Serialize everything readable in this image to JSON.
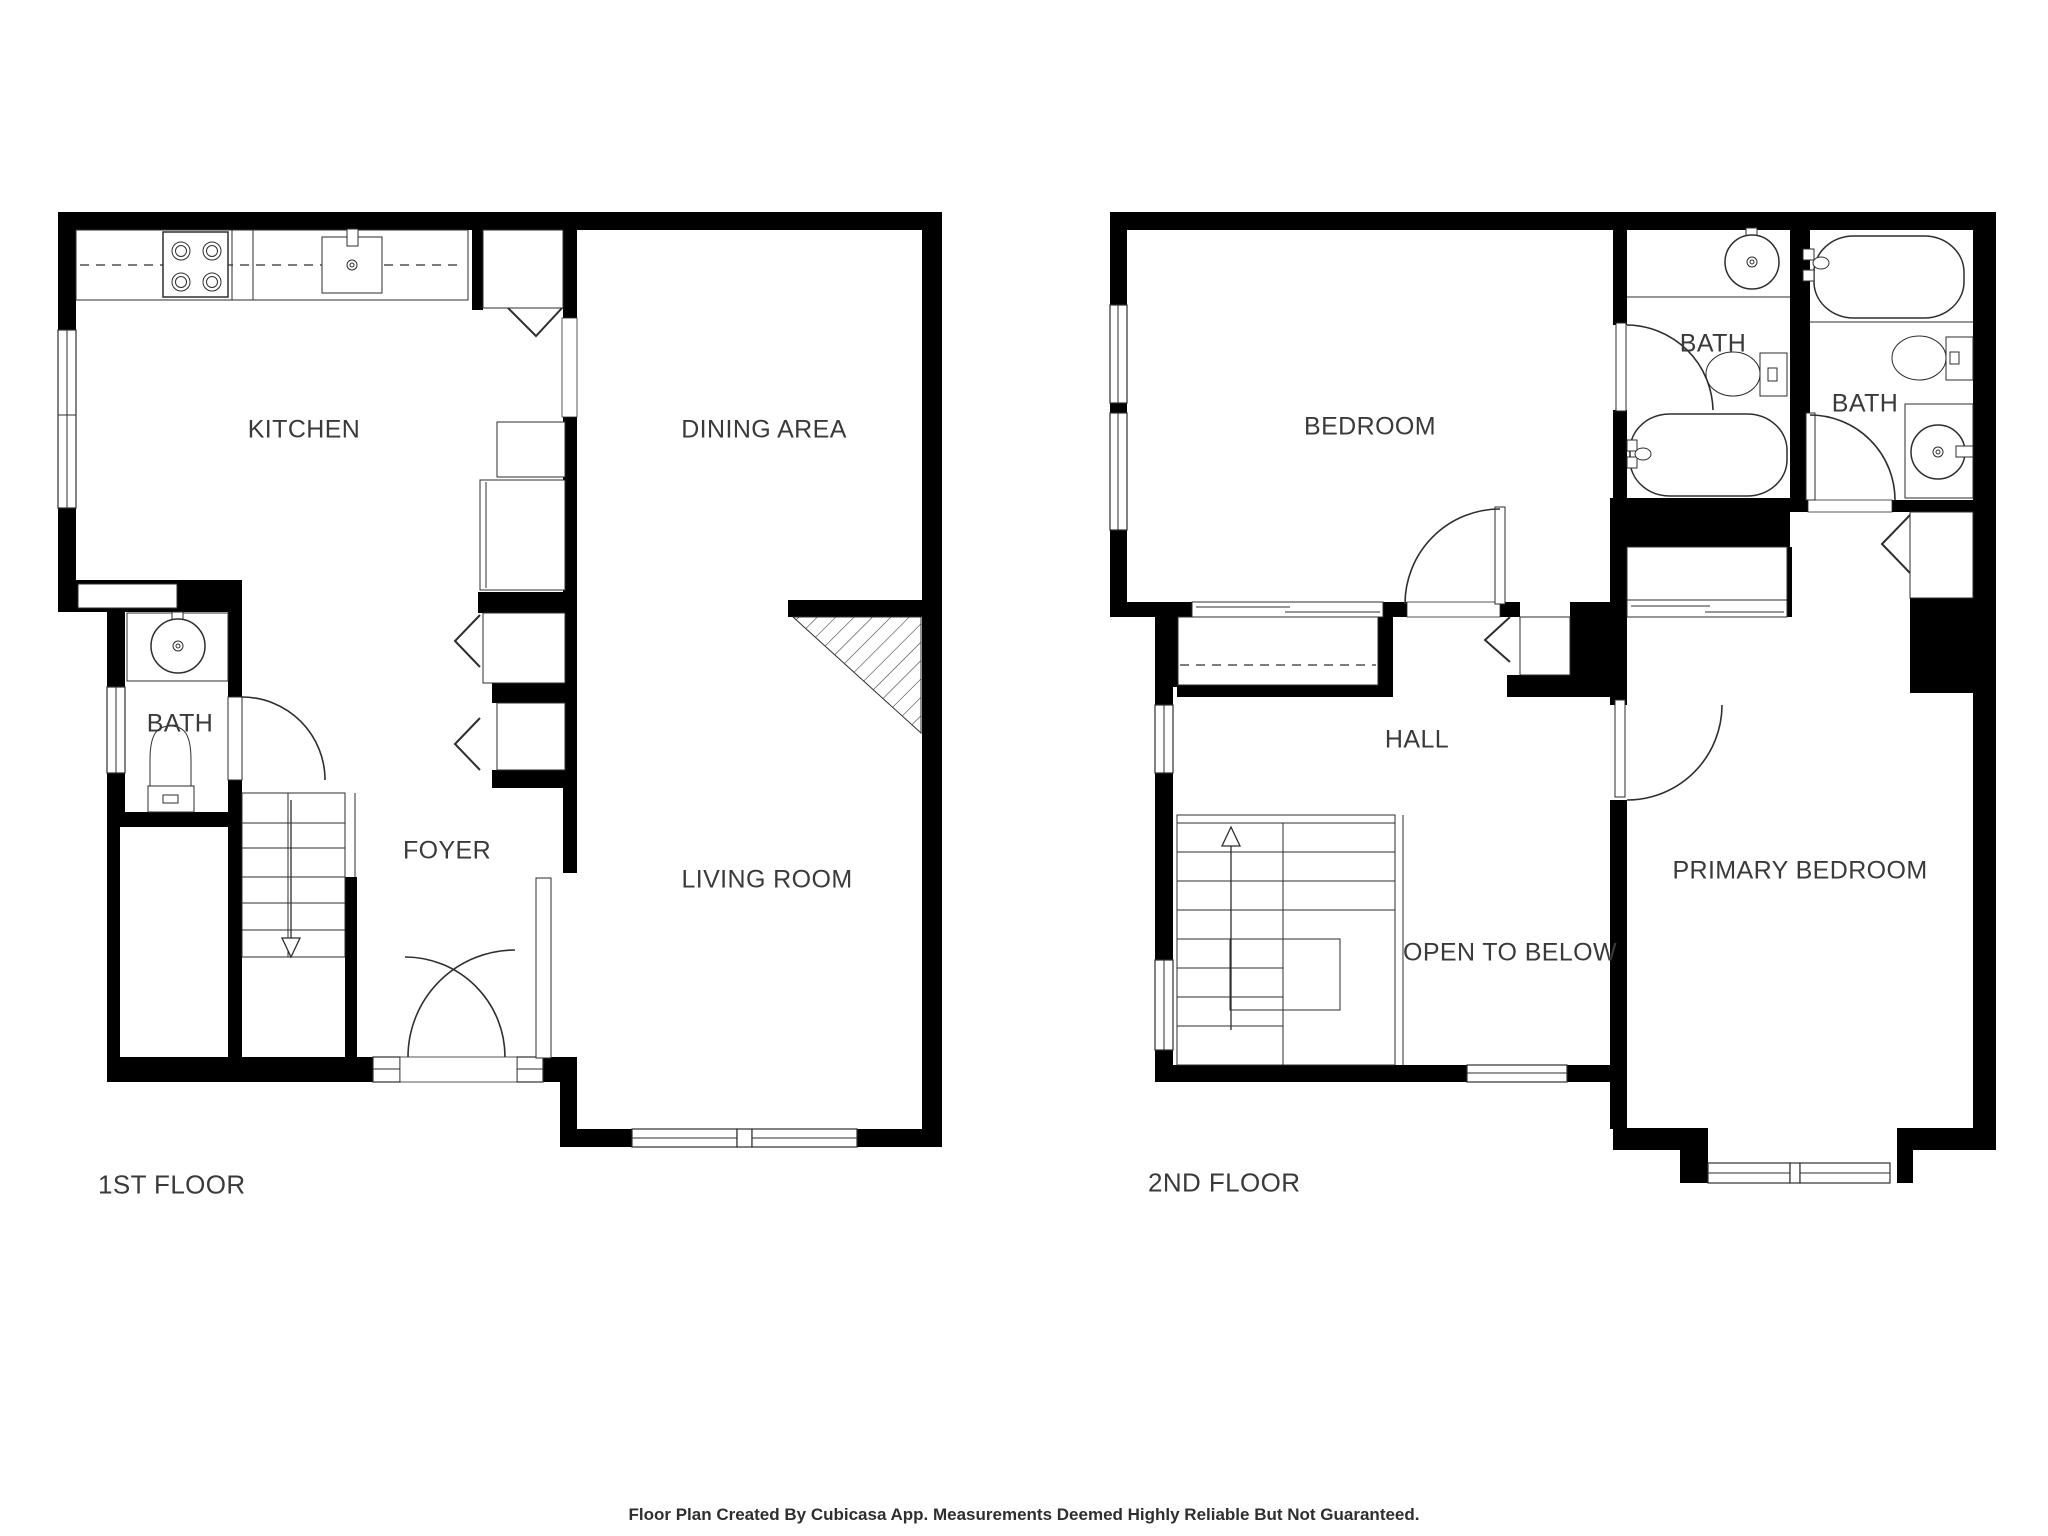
{
  "colors": {
    "wall": "#000000",
    "line": "#2e2e2e",
    "text": "#3a3a3a",
    "background": "#ffffff"
  },
  "floor1": {
    "title": "1ST FLOOR",
    "rooms": {
      "kitchen": "KITCHEN",
      "dining": "DINING AREA",
      "bath": "BATH",
      "foyer": "FOYER",
      "living": "LIVING ROOM"
    }
  },
  "floor2": {
    "title": "2ND FLOOR",
    "rooms": {
      "bedroom": "BEDROOM",
      "bath1": "BATH",
      "bath2": "BATH",
      "hall": "HALL",
      "open_to_below": "OPEN TO BELOW",
      "primary": "PRIMARY BEDROOM"
    }
  },
  "footer": {
    "text": "Floor Plan Created By Cubicasa App. Measurements Deemed Highly Reliable But Not Guaranteed."
  }
}
